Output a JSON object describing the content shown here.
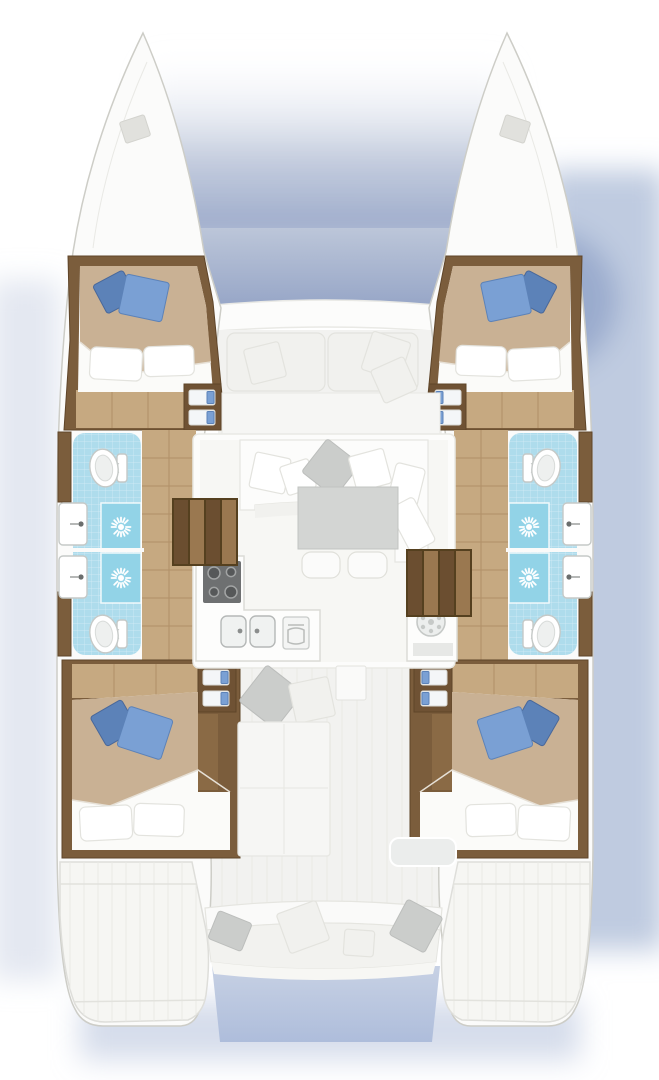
{
  "figure": {
    "type": "yacht-floor-plan",
    "subject": "Top-down accommodation and deck plan of a sailing catamaran",
    "layout_summary": "4 double cabins, 4 shower/toilet compartments, central saloon with galley and dining table, foredeck trampoline with seating, aft cockpit bench and transom steps"
  },
  "inventory": {
    "hulls": [
      "port",
      "starboard"
    ],
    "forward_cabins": 2,
    "aft_cabins": 2,
    "cabin_fixtures": [
      "double-bed",
      "blue-decor-pillows",
      "white-pillows",
      "storage-shelves",
      "wood-floor",
      "wardrobe"
    ],
    "bathrooms_per_hull": 2,
    "bathroom_fixtures": [
      "toilet",
      "washbasin",
      "shower-tray-with-sun-symbol",
      "cyan-tiled-floor"
    ],
    "saloon_fixtures": [
      "u-shaped-sofa",
      "scatter-pillows",
      "dining-table",
      "two-seats"
    ],
    "galley_fixtures": [
      "four-burner-stove",
      "double-sink",
      "oven"
    ],
    "utility_fixtures": [
      "washing-machine-cabinet"
    ],
    "deck_fixtures": [
      "bow-trampoline",
      "bow-deck-hatches",
      "foredeck-seating",
      "aft-cockpit-bench",
      "sun-pad",
      "storage-box",
      "transom-steps"
    ],
    "stairs": [
      "port-companionway-steps",
      "starboard-companionway-steps"
    ]
  },
  "colors": {
    "background": "#ffffff",
    "shadow_main": "#9fb0d0",
    "shadow_soft": "#c9d3e5",
    "trampoline_top": "#bcc6d9",
    "trampoline_bottom": "#97a6c7",
    "hull": "#fbfbfa",
    "hull_outline": "#cdcdc7",
    "deck_faded": "#f2f2f0",
    "deck_line": "#e9e9e5",
    "wall_white": "#fcfcfb",
    "saloon_floor": "#f7f7f4",
    "wood_trim": "#7b5d3c",
    "wood_trim_dark": "#5f4529",
    "wood_floor": "#c6a981",
    "wood_floor_line": "#b08f68",
    "wood_column": "#8a6a45",
    "wood_cabinet": "#6f5234",
    "bed_white": "#fbfbf9",
    "bed_tan": "#c9b194",
    "pillow_white": "#ffffff",
    "pillow_outline": "#e3e3de",
    "cushion_faded": "#f1f1ee",
    "pillow_gray": "#cbcdcb",
    "pillow_blue": "#7aa0d4",
    "pillow_blue_dark": "#5c82b8",
    "tile_cyan": "#aedcec",
    "shower_tray": "#92d3e7",
    "fixture_white": "#ffffff",
    "fixture_outline": "#c5c9c7",
    "counter_white": "#fdfdfc",
    "stove_dark": "#6e7071",
    "burner_ring": "#a2a4a4",
    "table_gray": "#d3d5d3",
    "seat_white": "#fbfbfa",
    "stair_dark": "#6b4e30",
    "stair_light": "#9a7850",
    "water_between_sterns": "#b7c4dc"
  }
}
